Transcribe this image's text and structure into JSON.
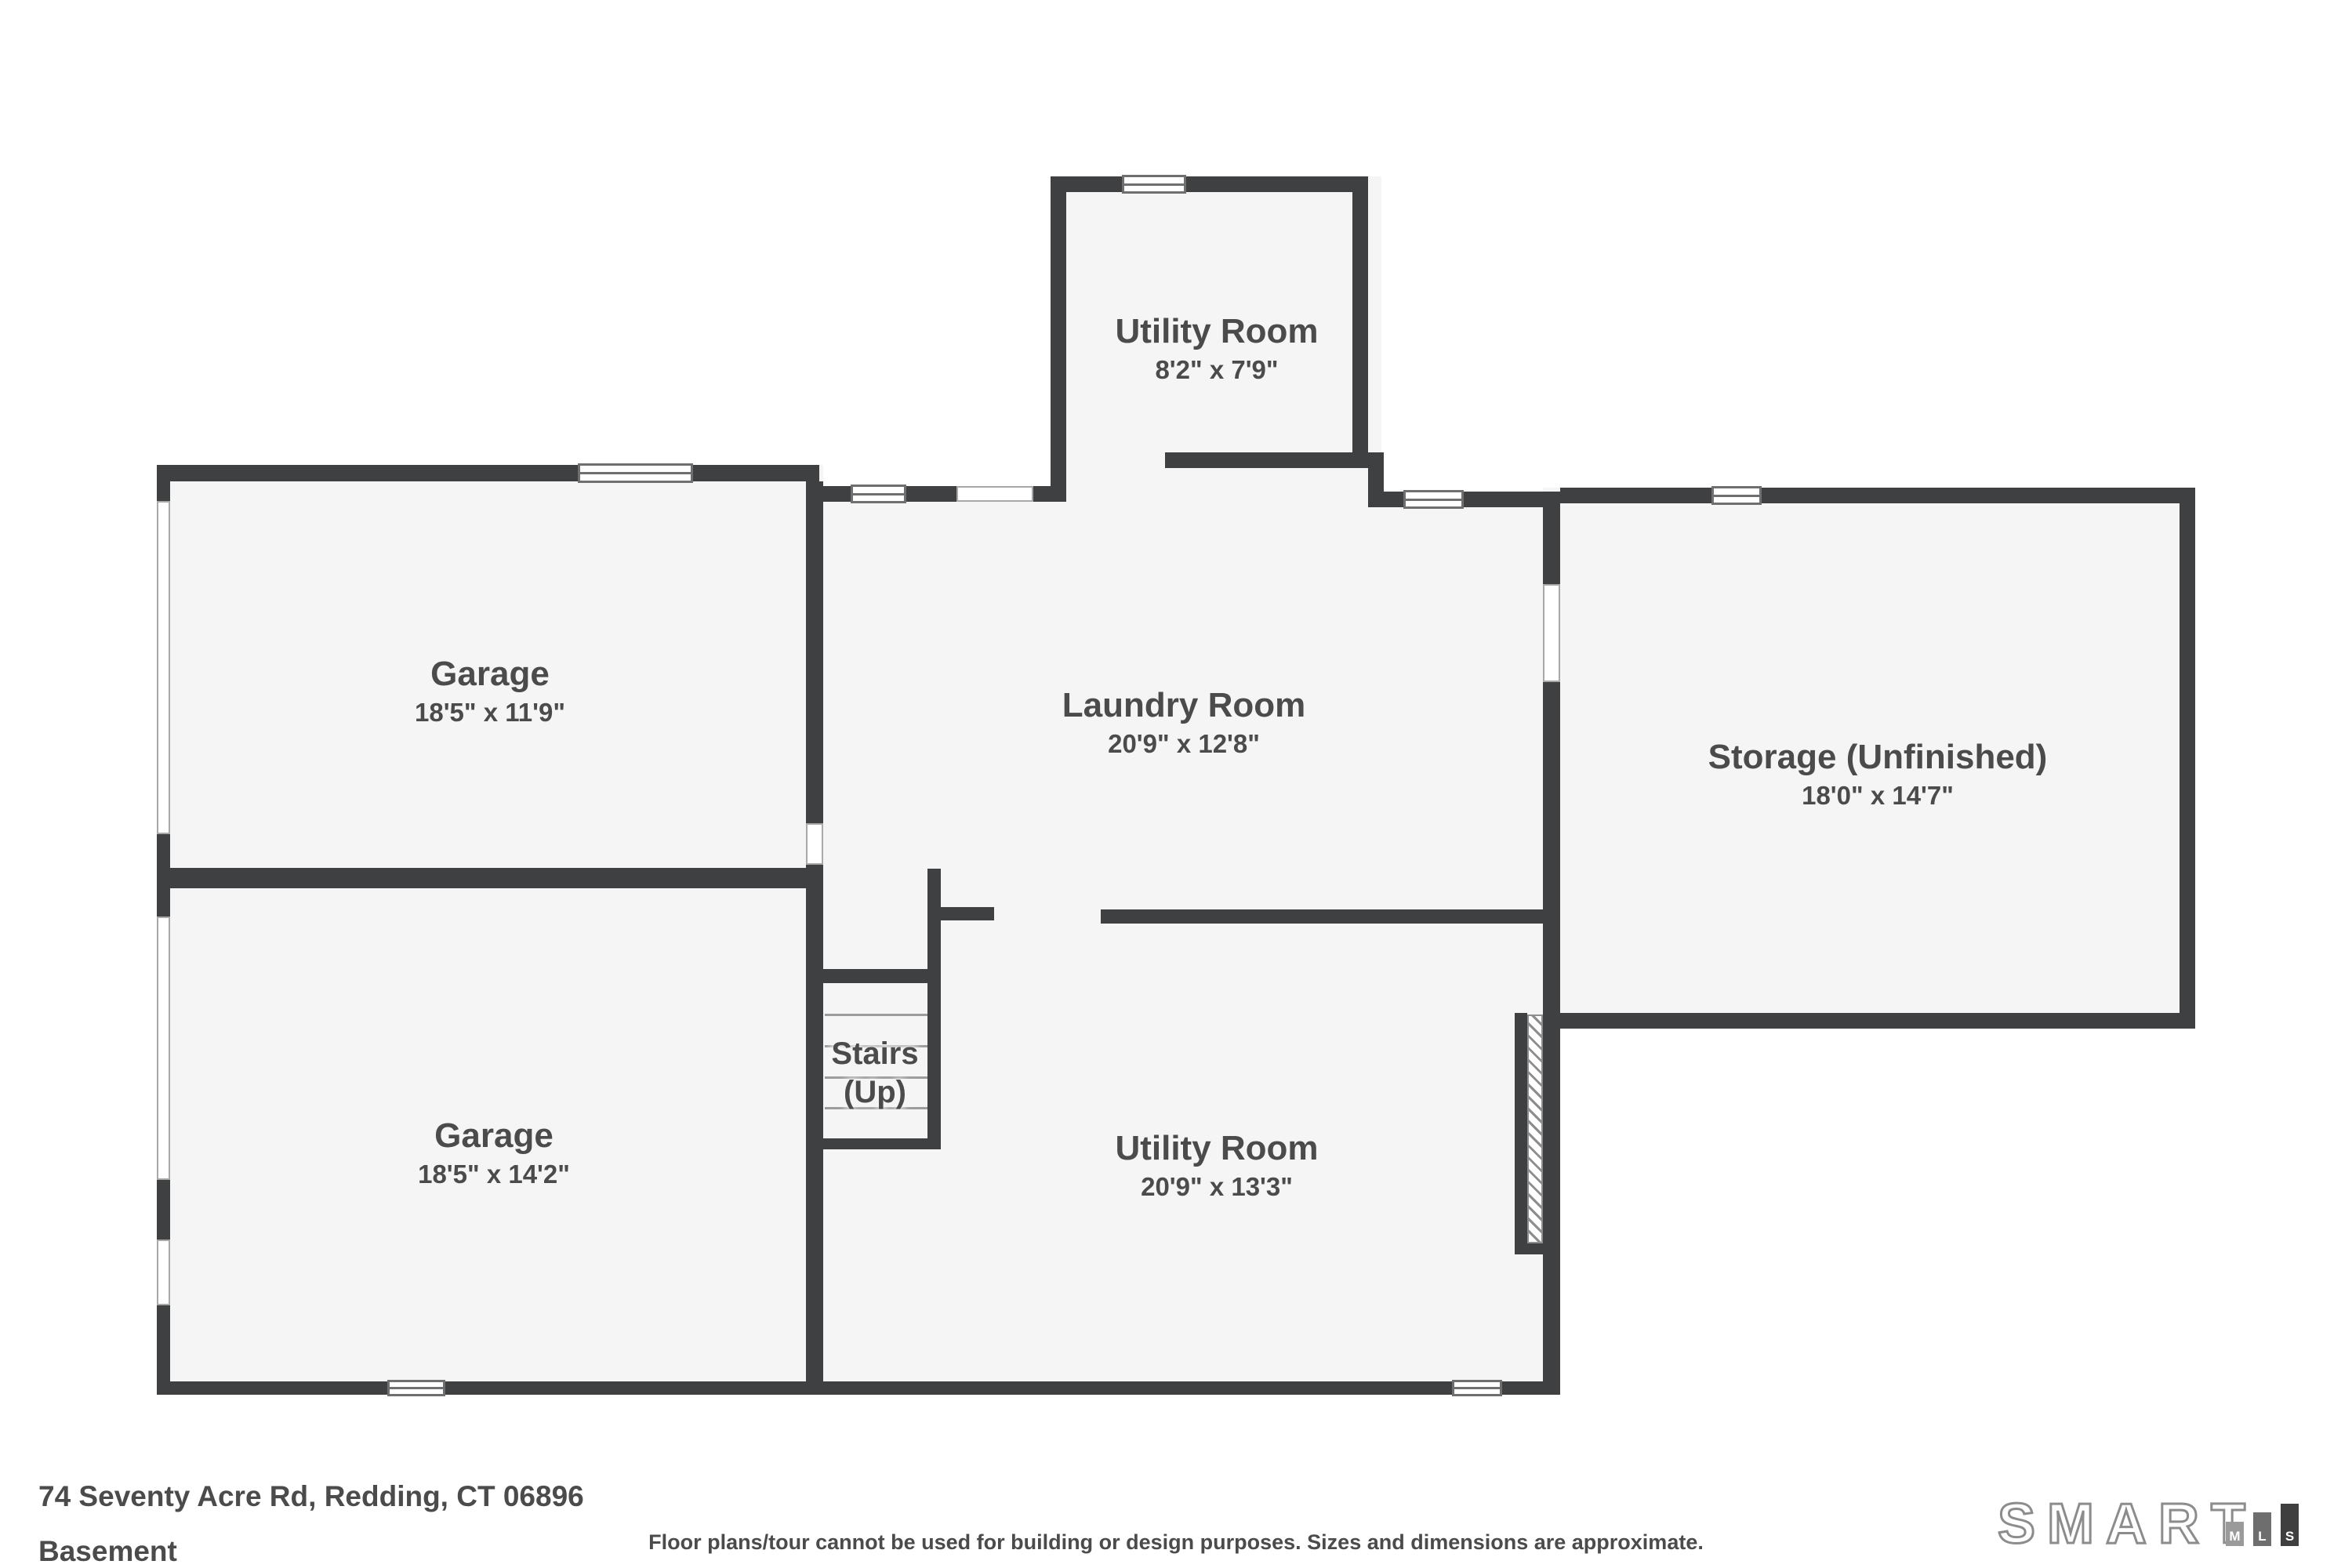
{
  "floorplan": {
    "rooms": [
      {
        "name": "Utility Room",
        "dims": "8'2\" x 7'9\""
      },
      {
        "name": "Garage",
        "dims": "18'5\" x 11'9\""
      },
      {
        "name": "Laundry Room",
        "dims": "20'9\" x 12'8\""
      },
      {
        "name": "Storage (Unfinished)",
        "dims": "18'0\" x 14'7\""
      },
      {
        "name": "Garage",
        "dims": "18'5\" x 14'2\""
      },
      {
        "name": "Utility Room",
        "dims": "20'9\" x 13'3\""
      },
      {
        "name": "Stairs",
        "dims": "(Up)"
      }
    ],
    "address": "74 Seventy Acre Rd, Redding, CT 06896",
    "level": "Basement",
    "disclaimer": "Floor plans/tour cannot be used for building or design purposes. Sizes and dimensions are approximate.",
    "logo": {
      "brand": "SMART",
      "letters": [
        "M",
        "L",
        "S"
      ]
    },
    "colors": {
      "wall": "#3f4042",
      "floor": "#f5f5f5",
      "label": "#4b4b4b"
    }
  }
}
